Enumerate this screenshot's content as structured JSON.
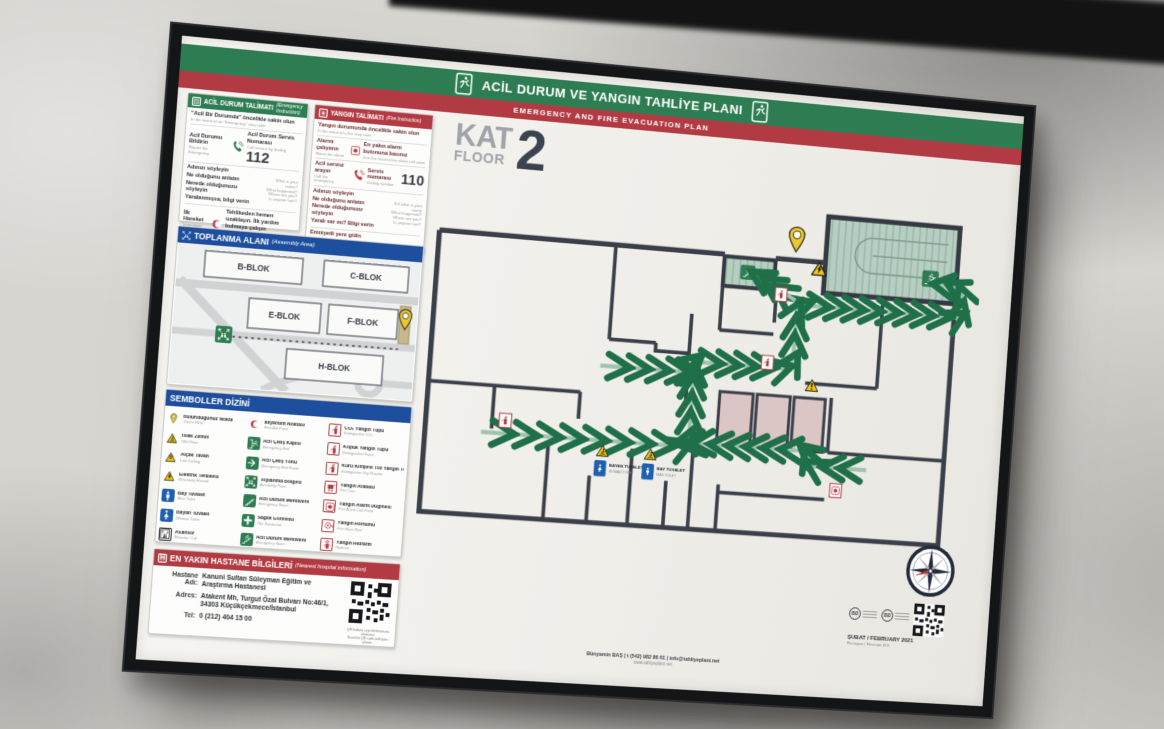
{
  "header": {
    "title_tr": "ACİL DURUM VE YANGIN TAHLİYE PLANI",
    "title_en": "EMERGENCY AND FIRE EVACUATION PLAN"
  },
  "floor": {
    "kat": "KAT",
    "floor_en": "FLOOR",
    "number": "2"
  },
  "emergency": {
    "title": "ACİL DURUM TALİMATI",
    "subtitle": "(Emergency Instruction)",
    "calm_tr": "\"Acil Bir Durumda\" öncelikle sakin olun",
    "calm_en": "In the event of an \"Emergency\" stay calm",
    "report_tr": "Acil Durumu Bildirin",
    "report_en": "Report the Emergency",
    "service_tr": "Acil Durum Servis Numarası",
    "service_en": "Call service by dialing",
    "number": "112",
    "q_tr_1": "Adınızı söyleyin",
    "q_tr_2": "Ne olduğunu anlatın",
    "q_tr_3": "Nerede olduğunuzu söyleyin",
    "q_tr_4": "Yaralanmışsa, bilgi verin",
    "q_en_1": "What is your name?",
    "q_en_2": "What happened?",
    "q_en_3": "Where are you?",
    "q_en_4": "Is anyone hurt?",
    "first_tr": "İlk Hareket",
    "first_en": "Immediate Action",
    "aid_tr": "Tehlikeden hemen uzaklaşın. İlk yardım bulmaya çalışın",
    "aid_en": "Move away from any danger. Try to find first aid",
    "follow_tr": "Güvenli yer işaretlerini takip edip çıkışı bulun",
    "follow_en": "Find the exit by following safety signs",
    "safe_tr": "Emniyetli Yere Gidin",
    "safe_en": "Get to safety"
  },
  "fire": {
    "title": "YANGIN TALİMATI",
    "subtitle": "(Fire Instruction)",
    "calm_tr": "Yangın durumunda öncelikle sakin olun",
    "calm_en": "In the event of a fire stay calm",
    "alarm_tr": "Alarmı çalıştırın",
    "alarm_en": "Raise the alarm",
    "alarm2_tr": "En yakın alarm butonuna basınız",
    "alarm2_en": "Use the closest fire alarm call point",
    "call_tr": "Acil servisi arayın",
    "call_en": "Call the emergency",
    "dial_tr": "Servis numarası",
    "dial_en": "Dialing number",
    "number": "110",
    "q_tr_1": "Adınızı söyleyin",
    "q_tr_2": "Ne olduğunu anlatın",
    "q_tr_3": "Nerede olduğunuzu söyleyin",
    "q_tr_4": "Yaralı var mı? Bilgi verin",
    "q_en_1": "Tell what is your name",
    "q_en_2": "What happened?",
    "q_en_3": "Where are you?",
    "q_en_4": "Is anyone hurt?",
    "safe_head_tr": "Emniyetli yere gidin",
    "safe_head_en": "Get to safety",
    "follow_tr": "Güvenli yer işaretlerini takip edip çıkışı bulun",
    "follow_en": "Leave the building by the nearest fire exit",
    "nobelong_tr": "Kişisel eşyalarınızı toplamaya çalışmayın",
    "nobelong_en": "Do NOT stop to collect personal belongings",
    "nolift_tr": "Asansörü kullanmayın",
    "nolift_en": "Do NOT use the lifts",
    "assemble_tr": "Toplanma noktasına gidin. Adres bilgi verin",
    "assemble_en": "Proceed directly to your assembly point"
  },
  "assembly": {
    "title": "TOPLANMA ALANI",
    "subtitle": "(Assembly Area)",
    "block_b": "B-BLOK",
    "block_c": "C-BLOK",
    "block_e": "E-BLOK",
    "block_f": "F-BLOK",
    "block_h": "H-BLOK"
  },
  "symbols": {
    "title": "SEMBOLLER DİZİNİ",
    "col1": [
      {
        "tr": "Bulunduğunuz Nokta",
        "en": "You're Here"
      },
      {
        "tr": "Islak Zemin",
        "en": "Wet Floor"
      },
      {
        "tr": "Alçak Tavan",
        "en": "Low Ceiling"
      },
      {
        "tr": "Elektrik Tehlikesi",
        "en": "Electricity Hazard"
      },
      {
        "tr": "Bay Tuvalet",
        "en": "Man Toilet"
      },
      {
        "tr": "Bayan Tuvalet",
        "en": "Woman Toilet"
      },
      {
        "tr": "Asansör",
        "en": "Elevator / Lift"
      }
    ],
    "col2": [
      {
        "tr": "İlkyardım Noktası",
        "en": "First Aid Point"
      },
      {
        "tr": "Acil Çıkış Kapısı",
        "en": "Emergency Exit"
      },
      {
        "tr": "Acil Çıkış Yönü",
        "en": "Emergency Exit Route"
      },
      {
        "tr": "Toplanma Bölgesi",
        "en": "Assembly Point"
      },
      {
        "tr": "Acil Durum Merdiveni",
        "en": "Emergency Stairs"
      },
      {
        "tr": "Sağlık Görevlisi",
        "en": "The Sanitarian"
      },
      {
        "tr": "Acil Durum Merdiveni",
        "en": "Emergency Stairs"
      }
    ],
    "col3": [
      {
        "tr": "CO₂ Yangın Tüpü",
        "en": "Extinguisher CO₂"
      },
      {
        "tr": "Köpük Yangın Tüpü",
        "en": "Extinguisher Foam"
      },
      {
        "tr": "Kuru Kimyevi Toz Yangın Tüpü",
        "en": "Extinguisher Dry Powder"
      },
      {
        "tr": "Yangın Arabası",
        "en": "Fire Cart"
      },
      {
        "tr": "Yangın Alarm Düğmesi",
        "en": "Fire Alarm Call Point"
      },
      {
        "tr": "Yangın Hortumu",
        "en": "Fire Hose Reel"
      },
      {
        "tr": "Yangın Hidrantı",
        "en": "Hydrant"
      }
    ]
  },
  "hospital": {
    "title": "EN YAKIN HASTANE BİLGİLERİ",
    "subtitle": "(Nearest hospital information)",
    "name_label": "Hastane Adı:",
    "name1": "Kanuni Sultan Süleyman Eğitim ve",
    "name2": "Araştırma Hastanesi",
    "addr_label": "Adres:",
    "addr1": "Atakent Mh, Turgut Özal Bulvarı No:46/1,",
    "addr2": "34303 Küçükçekmece/İstanbul",
    "tel_label": "Tel:",
    "tel": "0 (212) 404 15 00",
    "qr_cap1": "QR kodunu cep telefonunuza okutunuz",
    "qr_cap2": "Scan the QR code with your phone"
  },
  "plan": {
    "toilet_w1": "BAYAN TUVALET",
    "toilet_w2": "WOMAN TOILET",
    "toilet_m1": "BAY TUVALET",
    "toilet_m2": "MAN TOILET"
  },
  "footer": {
    "credit": "Bünyamin BAŞ | t (542) 982 86 61 | info@tahliyeplani.net",
    "site": "www.tahliyeplani.net",
    "iso1": "ISO",
    "iso2": "ISO",
    "date": "ŞUBAT / FEBRUARY 2021",
    "revision": "Revizyon / Revision 001"
  },
  "colors": {
    "green": "#2e7d52",
    "red": "#b23b43",
    "blue": "#1d4f9e",
    "route": "#9cc4ae",
    "wall": "#3a3f49"
  }
}
